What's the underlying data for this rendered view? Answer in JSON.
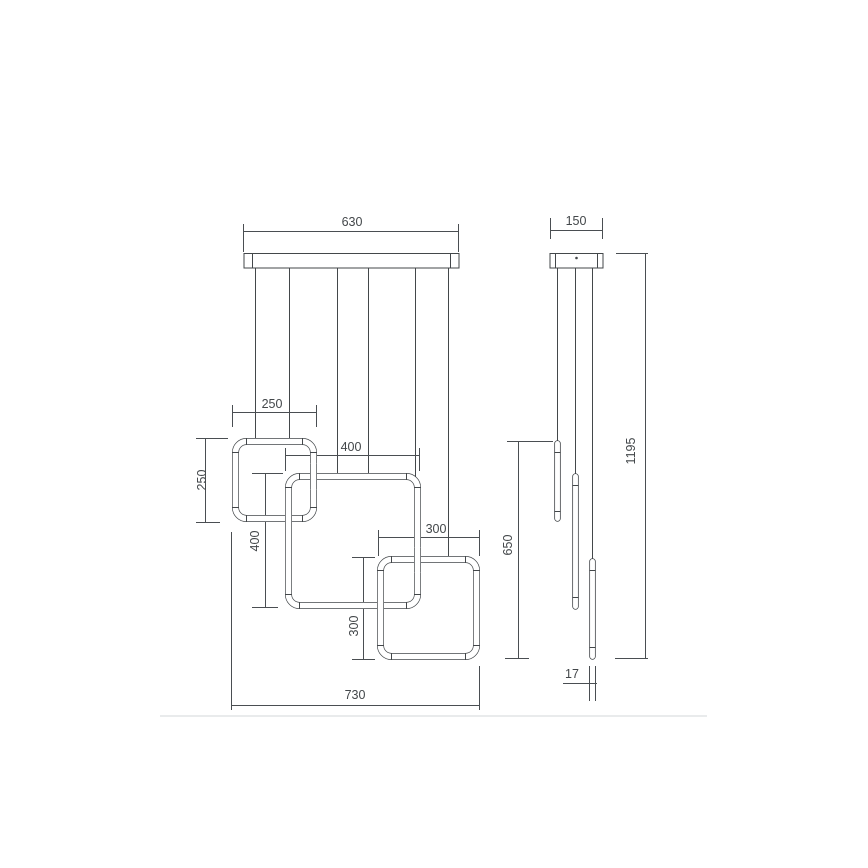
{
  "drawing": {
    "kind": "pendant-lamp-technical-dimension-drawing",
    "line_color": "#43474a",
    "text_color": "#43474a",
    "divider_color": "#e9ebec",
    "front_view": {
      "canopy_width": "630",
      "square_small_width": "250",
      "square_small_height": "250",
      "square_medium_width": "400",
      "square_medium_height": "400",
      "square_third_width": "300",
      "square_third_height": "300",
      "overall_width": "730"
    },
    "side_view": {
      "canopy_depth": "150",
      "tubes_span_height": "650",
      "overall_height": "1195",
      "tube_diameter": "17"
    }
  }
}
